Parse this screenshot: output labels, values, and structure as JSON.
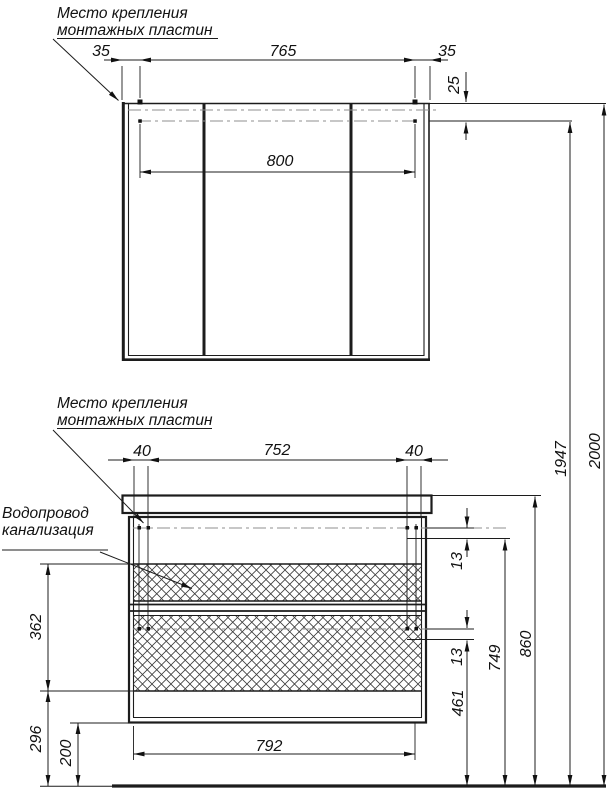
{
  "notes": {
    "mounting_top": {
      "line1": "Место крепления",
      "line2": "монтажных пластин"
    },
    "mounting_mid": {
      "line1": "Место крепления",
      "line2": "монтажных пластин"
    },
    "plumbing": {
      "line1": "Водопровод",
      "line2": "канализация"
    }
  },
  "dimensions": {
    "mirror": {
      "offset_left": "35",
      "span": "765",
      "offset_right": "35",
      "plate_inset": "25",
      "width": "800"
    },
    "vanity": {
      "offset_left": "40",
      "span": "752",
      "offset_right": "40",
      "gap_upper": "13",
      "gap_lower": "13",
      "front_height": "362",
      "front_bottom_to_floor": "296",
      "floor_clearance": "200",
      "bottom_width": "792"
    },
    "heights": {
      "lower_plate": "461",
      "upper_plate": "749",
      "countertop": "860",
      "mirror_plate": "1947",
      "overall": "2000"
    }
  },
  "colors": {
    "line": "#1c1c1c",
    "centerline": "#8f8f8f",
    "hatch": "#3c3c3c",
    "background": "#ffffff"
  }
}
